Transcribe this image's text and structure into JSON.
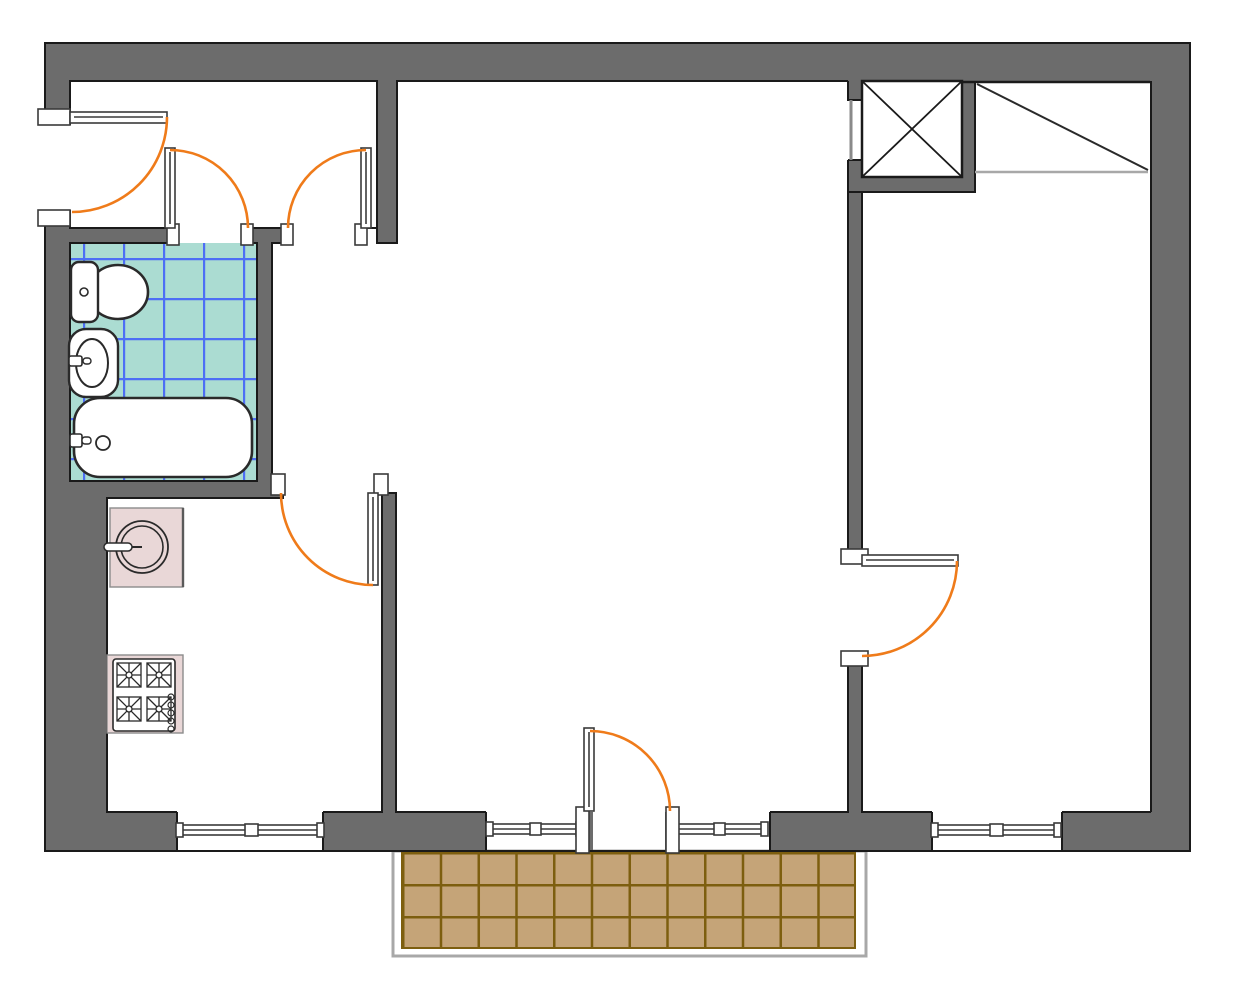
{
  "drawing": {
    "kind": "apartment floor plan, top-down view, no text labels",
    "rooms": [
      "entry-hall",
      "bathroom",
      "kitchen",
      "living-room",
      "bedroom",
      "balcony"
    ],
    "fixtures": [
      "toilet",
      "wash-basin",
      "bathtub",
      "kitchen-round-sink",
      "stove-4-burners",
      "elevator-shaft-x",
      "wardrobe-diagonal"
    ],
    "doors": [
      "entrance-door",
      "bathroom-door",
      "hallway-door",
      "kitchen-door",
      "bedroom-door",
      "balcony-door"
    ],
    "windows": [
      "kitchen-window",
      "living-window-left",
      "living-window-right",
      "bedroom-window"
    ],
    "door_swing_count": 6,
    "balcony_tiles": {
      "columns": 12,
      "rows": 3
    },
    "bathroom_tile_cell_px": 40
  },
  "colors": {
    "wall": "#6c6c6c",
    "outline": "#1a1a1a",
    "door_arc": "#ef7b1a",
    "thin_wall": "#8a8a8a",
    "bathroom_tile": "#abdcd2",
    "bathroom_grid": "#4d6ef5",
    "balcony_tile": "#c5a478",
    "balcony_grid": "#7d5e0f",
    "balcony_outline": "#a8a8a8",
    "counter": "#e9d7d7",
    "counter_edge": "#8c8c8c",
    "fixture_stroke": "#2a2a2a"
  }
}
